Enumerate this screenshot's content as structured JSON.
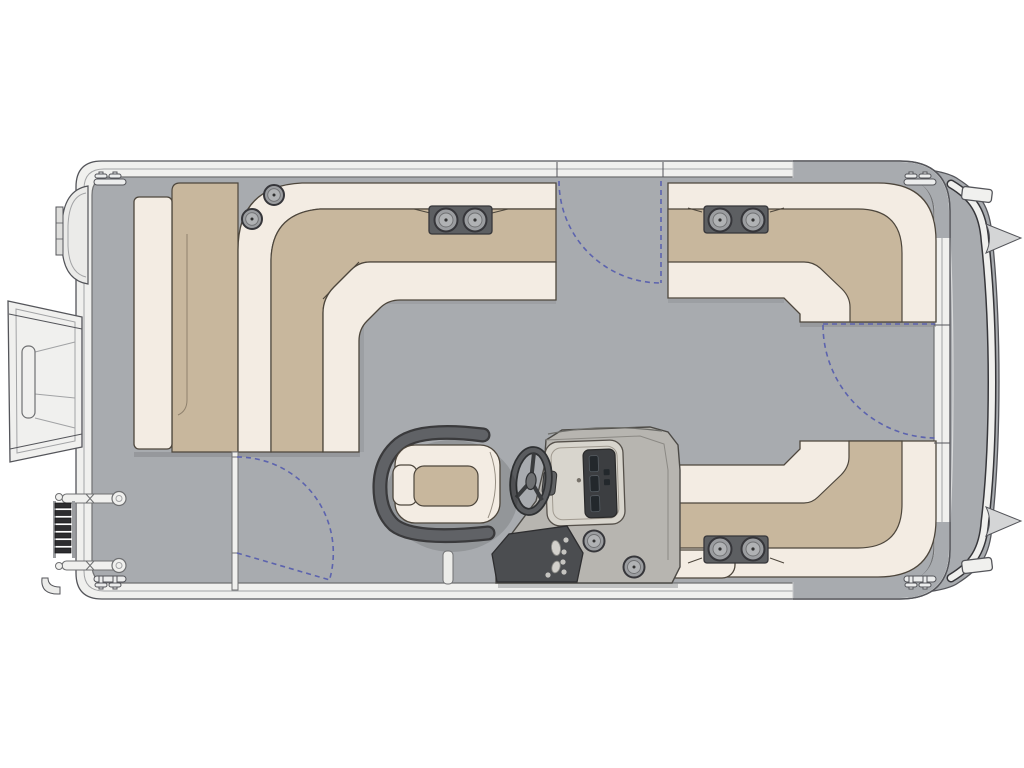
{
  "meta": {
    "diagram_type": "pontoon-boat-floor-plan",
    "view": "top-down"
  },
  "palette": {
    "deck": "#a8abaf",
    "deck_line": "#6f7072",
    "hull_trim": "#f0f0ee",
    "hull_outline": "#54555a",
    "band_line": "#a2a3a5",
    "cushion_light": "#f3ece3",
    "cushion_tan": "#c8b79d",
    "cushion_edge": "#4d463c",
    "tan_seam": "#8f816d",
    "hardware_dark": "#5d5f62",
    "hardware_outline": "#36363a",
    "metal": "#9b9da0",
    "metal_light": "#b0b2b4",
    "console_body": "#b7b5b0",
    "console_pod": "#d8d5cd",
    "screen_dark": "#3c3e41",
    "panel_dark": "#4b4d50",
    "gate_blue": "#5c63ae",
    "shadow": "#87898c",
    "ladder_dark": "#2e2e30",
    "fin_gray": "#d4d5d6",
    "nose_gray": "#ebebe9"
  },
  "components": {
    "seating": [
      "bow-l-lounge",
      "upper-stern-l-lounge",
      "lower-stern-l-lounge",
      "captains-chair"
    ],
    "helm": [
      "steering-wheel",
      "dash-pod",
      "switch-panel",
      "console-cupholders"
    ],
    "gates": [
      "top-side-gate",
      "stern-side-gate",
      "bow-cross-gate"
    ],
    "hardware": [
      "bow-gangway",
      "boarding-ladder",
      "nose-cone",
      "cleats-x4",
      "speakers-x2",
      "ski-pylon",
      "stern-fins-x2"
    ],
    "cupholder_trays": 4,
    "speakers": 2,
    "cleats": 4
  }
}
